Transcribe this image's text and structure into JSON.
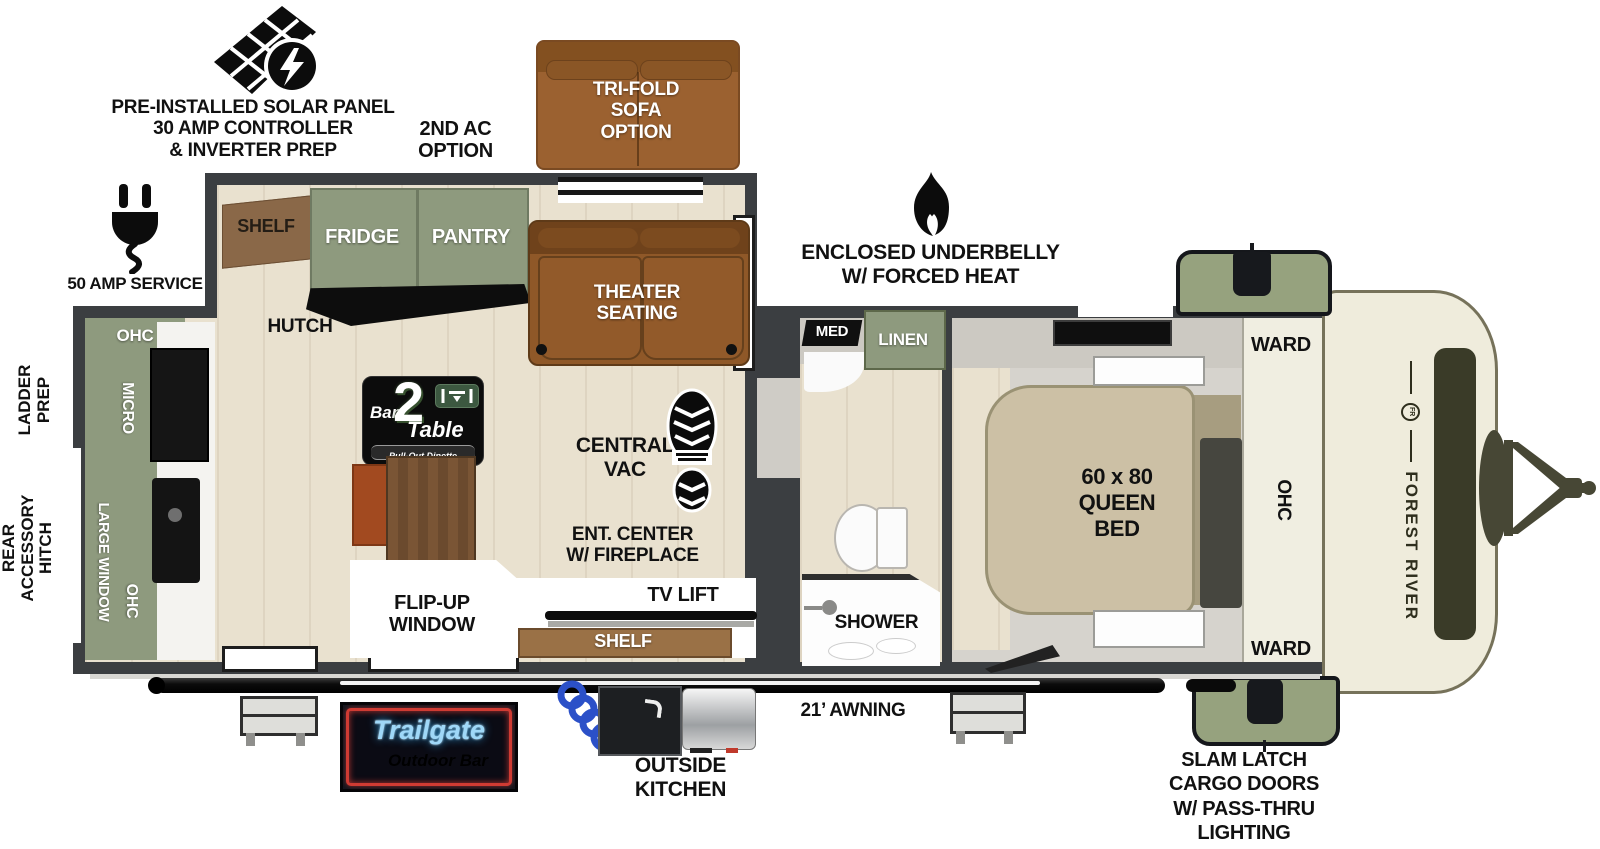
{
  "exterior": {
    "solar": {
      "line1": "PRE-INSTALLED SOLAR PANEL",
      "line2": "30 AMP CONTROLLER",
      "line3": "& INVERTER PREP"
    },
    "second_ac": {
      "line1": "2ND AC",
      "line2": "OPTION"
    },
    "tri_fold": {
      "line1": "TRI-FOLD",
      "line2": "SOFA",
      "line3": "OPTION"
    },
    "amp_service": "50 AMP SERVICE",
    "underbelly": {
      "line1": "ENCLOSED UNDERBELLY",
      "line2": "W/ FORCED HEAT"
    },
    "ladder_prep": {
      "line1": "LADDER",
      "line2": "PREP"
    },
    "rear_hitch": {
      "line1": "REAR",
      "line2": "ACCESSORY",
      "line3": "HITCH"
    },
    "awning": "21’ AWNING",
    "outside_kitchen": {
      "line1": "OUTSIDE",
      "line2": "KITCHEN"
    },
    "slam_latch": {
      "line1": "SLAM LATCH",
      "line2": "CARGO DOORS",
      "line3": "W/ PASS-THRU",
      "line4": "LIGHTING"
    },
    "front_brand": "FOREST RIVER",
    "front_logo": "FR"
  },
  "living": {
    "shelf": "SHELF",
    "fridge": "FRIDGE",
    "pantry": "PANTRY",
    "hutch": "HUTCH",
    "theater": {
      "line1": "THEATER",
      "line2": "SEATING"
    },
    "central_vac": {
      "line1": "CENTRAL",
      "line2": "VAC"
    },
    "ent_center": {
      "line1": "ENT. CENTER",
      "line2": "W/ FIREPLACE"
    },
    "tv_lift": "TV LIFT",
    "shelf_lower": "SHELF",
    "flip_up": {
      "line1": "FLIP-UP",
      "line2": "WINDOW"
    }
  },
  "rear_kitchen": {
    "ohc_top": "OHC",
    "micro": "MICRO",
    "large_window": "LARGE WINDOW",
    "ohc_side": "OHC"
  },
  "bathroom": {
    "med": "MED",
    "linen": "LINEN",
    "shower": "SHOWER"
  },
  "bedroom": {
    "bed": {
      "line1": "60 x 80",
      "line2": "QUEEN",
      "line3": "BED"
    },
    "ward_top": "WARD",
    "ohc": "OHC",
    "ward_bottom": "WARD"
  },
  "logos": {
    "bar2table": {
      "bar": "Bar",
      "two": "2",
      "table": "Table",
      "tagline": "Pull-Out Dinette"
    },
    "trailgate": {
      "name": "Trailgate",
      "tagline": "Outdoor Bar"
    }
  },
  "colors": {
    "wall": "#3b3e41",
    "floor_wood": "#e9e1cf",
    "cabinet_green": "#8e9a7e",
    "sofa_brown": "#8f5828",
    "bed_tan": "#ccc0a5",
    "cap_cream": "#efecdc",
    "neon_blue": "#9fd8f8",
    "neon_gold": "#e3b156",
    "neon_red": "#cf3b33"
  }
}
